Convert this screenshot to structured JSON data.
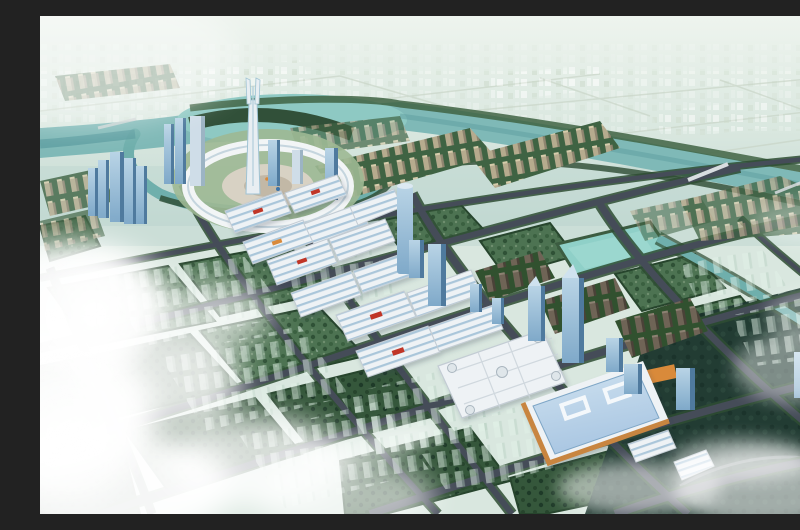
{
  "scene": {
    "type": "aerial-architectural-rendering",
    "svg_title": "Aerial rendering of a planned riverside exhibition city",
    "description": "Bird's-eye master-plan rendering of a new town: a river loops around a circular landmark hub crowned by a twin-pronged spire; rows of white exhibition halls with blue-striped roofs march along a diagonal boulevard flanked by glass office towers; beige and bronze residential slab rows, green development parcels with translucent future buildings, a blue-roofed convention centre with timber trim, wetland ponds and sunlit clouds complete the scene.",
    "landmarks": {
      "sky": "Hazy sky and distant plains",
      "far_city": "Distant low-rise city fabric",
      "river": "River with oxbow loop around the hub",
      "hub": "Circular gateway hub with ring canopy",
      "spire": "Twin-pronged landmark spire",
      "hub_towers": "Hub high-rise towers",
      "west_towers": "Western glass tower cluster",
      "halls": "Exhibition halls with blue-striped roofs",
      "mall": "Domed shopping mall",
      "convention": "Convention centre with blue glass roof and timber trim",
      "towers": "Glass office towers along the boulevard",
      "residential_beige": "Beige riverside residential rows",
      "residential_bronze": "Bronze residential tower rows",
      "parcels": "Green development parcels",
      "ghosts": "Translucent future buildings",
      "wetland": "Wetland pond block",
      "canal": "Drainage canal to the southeast",
      "roads": "Arterial road grid with tree-lined verges",
      "bridges": "River bridges",
      "fields": "Outlying dark farm fields under fog",
      "clouds": "Clouds and sun glare"
    }
  },
  "palette": {
    "sky_top": "#eef4ee",
    "sky_mid": "#d9e7df",
    "horizon_haze": "#c2d8d2",
    "far_city": "#b7c9b9",
    "river": "#7fb9b7",
    "river_deep": "#5d9da0",
    "lake": "#8ec9c3",
    "canal": "#6fafac",
    "foliage_dark": "#2c4a31",
    "foliage_mid": "#3f6343",
    "block_green": "#4d7352",
    "block_green_dark": "#35573b",
    "field_dark": "#223c33",
    "road": "#454c58",
    "road_green": "#2e4d33",
    "road_light": "#8d939e",
    "hall_white": "#eef2f5",
    "hall_roof_blue": "#aac6da",
    "hall_stripe": "#5b87b0",
    "accent_red": "#c03428",
    "accent_orange": "#d98a3a",
    "tower_glass": "#7fa9c9",
    "tower_glass_light": "#b9d4e6",
    "tower_glass_dark": "#4f7a9e",
    "residential_beige": "#b6ab8e",
    "residential_beige_dark": "#8f8570",
    "residential_bronze": "#6f6456",
    "residential_bronze_dark": "#4a4238",
    "flagship_roof": "#a9c6e2",
    "flagship_trim": "#c8853f",
    "plaza": "#d8d2c4",
    "spire": "#e8eef2",
    "cloud": "#ffffff"
  }
}
